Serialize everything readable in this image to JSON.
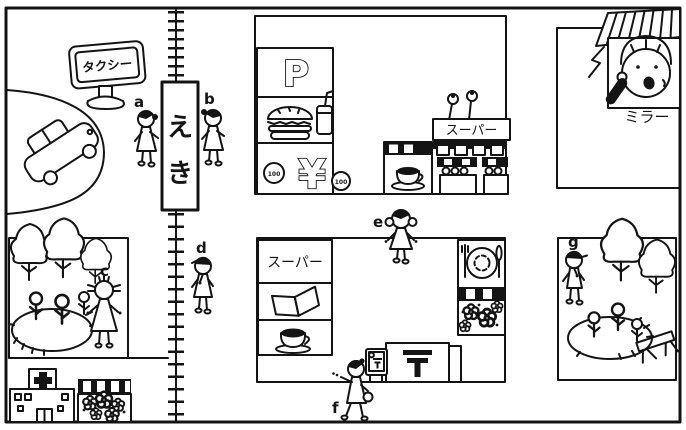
{
  "station": {
    "sign_chars": [
      "え",
      "き"
    ]
  },
  "taxi_stand": {
    "sign_text": "タクシー"
  },
  "person_labels": {
    "a": "a",
    "b": "b",
    "c": "c",
    "d": "d",
    "e": "e",
    "f": "f",
    "g": "g"
  },
  "top_block": {
    "parking_sign": "P",
    "yen_sign": "¥",
    "coin_left": "100",
    "coin_right": "100",
    "supermarket_sign": "スーパー"
  },
  "phone_caller": {
    "name": "ミラー"
  },
  "middle_block": {
    "supermarket_sign": "スーパー"
  },
  "post_office": {
    "symbol": "〒"
  },
  "mailbox": {
    "symbol": "〒"
  },
  "icons": {
    "taxi_car": "taxi-car",
    "fast_food": "hamburger-and-drink",
    "money": "yen-with-coins",
    "cafe": "coffee-cup",
    "supermarket": "market-stalls",
    "bookstore": "open-book",
    "restaurant": "fork-plate-knife",
    "flower_shop": "flowers-under-awning",
    "hospital": "building-with-cross",
    "park": "trees-flowerbed-bench",
    "railroad": "train-track",
    "phone": "telephone-receiver",
    "post": "postal-mark"
  }
}
